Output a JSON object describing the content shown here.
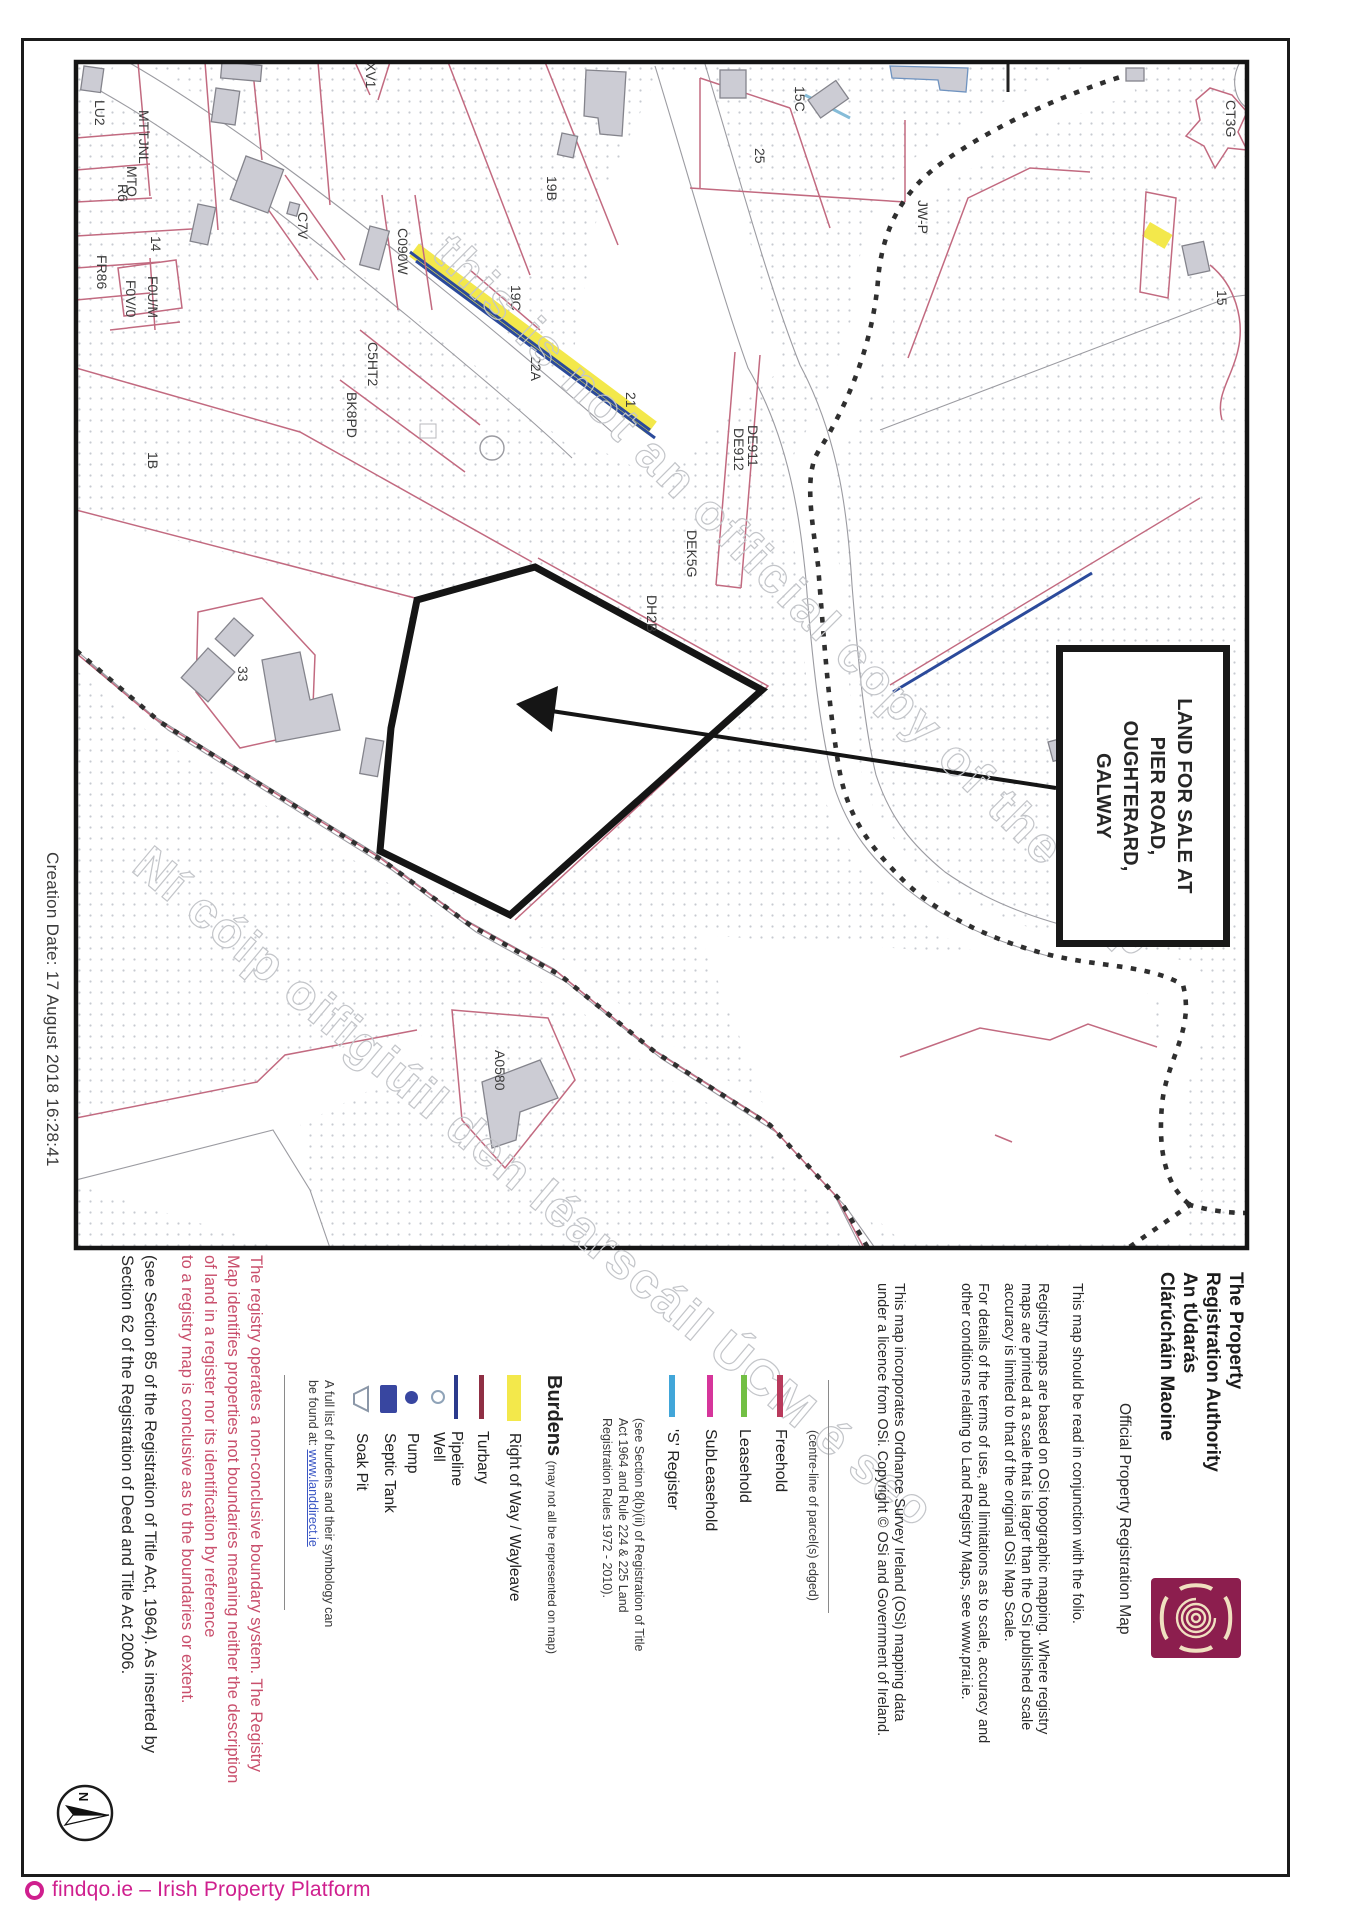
{
  "page": {
    "creation_date": "Creation Date: 17 August 2018 16:28:41",
    "watermark_en": "this is not an official copy of the map",
    "watermark_ga": "Ní cóip oifigiúil den léarscáil ÚCM é seo"
  },
  "sale_box": {
    "line1": "LAND FOR SALE AT",
    "line2": "PIER ROAD,",
    "line3": "OUGHTERARD,",
    "line4": "GALWAY"
  },
  "authority": {
    "name_line1": "The Property",
    "name_line2": "Registration Authority",
    "name_ga_line1": "An tÚdarás",
    "name_ga_line2": "Clárúcháin Maoine",
    "subtitle": "Official Property Registration Map"
  },
  "notes": {
    "folio": "This map should be read in conjunction with the folio.",
    "registry_1": "Registry maps are based on OSi topographic mapping. Where registry",
    "registry_2": "maps are printed at a scale that is larger than the OSi published scale",
    "registry_3": "accuracy is limited to that of the original OSi Map Scale.",
    "terms_1": "For details of the terms of use, and limitations as to scale, accuracy and",
    "terms_2": "other conditions relating to Land Registry Maps, see www.prai.ie.",
    "osi_1": "This map incorporates Ordnance Survey Ireland (OSi) mapping data",
    "osi_2": "under a licence from OSi. Copyright © OSi and Government of Ireland."
  },
  "legend": {
    "centre_note": "(centre-line of parcel(s) edged)",
    "freehold": {
      "label": "Freehold",
      "color": "#b93a5c"
    },
    "leasehold": {
      "label": "Leasehold",
      "color": "#72bf44"
    },
    "subleasehold": {
      "label": "SubLeasehold",
      "color": "#d6359b"
    },
    "s_register": {
      "label": "'S' Register",
      "color": "#41a6d9"
    },
    "section_1": "(see Section 8(b)(ii) of Registration of Title",
    "section_2": "Act 1964 and Rule 224 & 225 Land",
    "section_3": "Registration Rules 1972 - 2010).",
    "burdens_title": "Burdens",
    "burdens_note": "(may not all be represented on map)",
    "right_of_way": {
      "label": "Right of Way / Wayleave",
      "color": "#f3e84b"
    },
    "turbary": {
      "label": "Turbary",
      "color": "#8f2f44"
    },
    "pipeline": {
      "label": "Pipeline",
      "color": "#2b3a8c"
    },
    "well": {
      "label": "Well"
    },
    "pump": {
      "label": "Pump"
    },
    "septic_tank": {
      "label": "Septic Tank"
    },
    "soak_pit": {
      "label": "Soak Pit"
    },
    "full_list_1": "A full list of burdens and their symbology can",
    "full_list_2": "be found at: ",
    "full_list_link": "www.landdirect.ie"
  },
  "boundary_notice": {
    "line1": "The registry operates a non-conclusive boundary system. The Registry",
    "line2": "Map identifies properties not boundaries meaning neither the description",
    "line3": "of land in a register nor its identification by reference",
    "line4": "to a registry map is conclusive as to the boundaries or extent."
  },
  "legal_note": {
    "line1": "(see Section 85 of the Registration of Title Act, 1964). As inserted by",
    "line2": "Section 62 of the Registration of Deed and Title Act 2006."
  },
  "north_arrow": {
    "label": "N"
  },
  "footer": {
    "text": "findqo.ie – Irish Property Platform"
  },
  "map": {
    "labels": [
      {
        "text": "LU2"
      },
      {
        "text": "MTTJNL"
      },
      {
        "text": "MTO"
      },
      {
        "text": "R6"
      },
      {
        "text": "14"
      },
      {
        "text": "FR86"
      },
      {
        "text": "F0V/0"
      },
      {
        "text": "F0U/M"
      },
      {
        "text": "C7V"
      },
      {
        "text": "XV1"
      },
      {
        "text": "C090W"
      },
      {
        "text": "19B"
      },
      {
        "text": "19C"
      },
      {
        "text": "22A"
      },
      {
        "text": "25"
      },
      {
        "text": "15C"
      },
      {
        "text": "JW-P"
      },
      {
        "text": "CT3G"
      },
      {
        "text": "15"
      },
      {
        "text": "21"
      },
      {
        "text": "DE911"
      },
      {
        "text": "DE912"
      },
      {
        "text": "DEK5G"
      },
      {
        "text": "DH2B"
      },
      {
        "text": "33"
      },
      {
        "text": "1B"
      },
      {
        "text": "C5HT2"
      },
      {
        "text": "BK8PD"
      },
      {
        "text": "A0580"
      }
    ]
  }
}
